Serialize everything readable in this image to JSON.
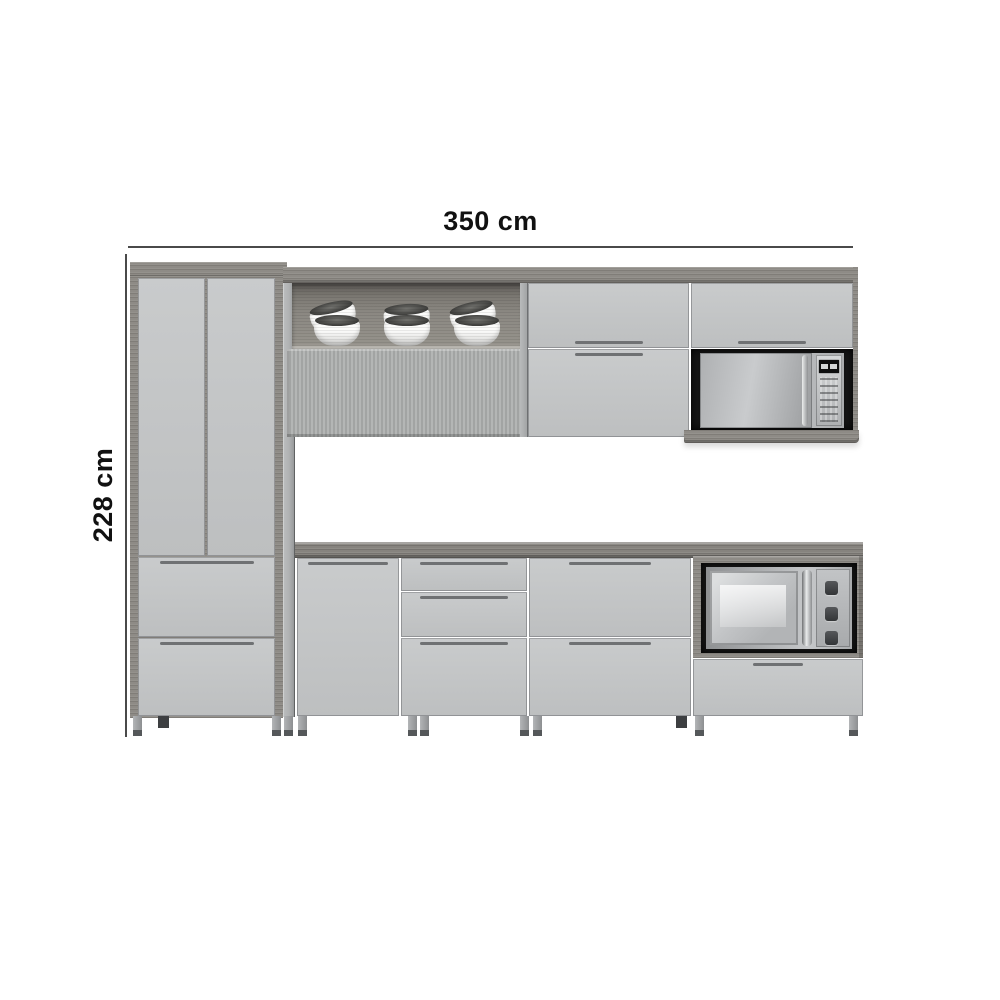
{
  "annotations": {
    "width_label": "350 cm",
    "height_label": "228 cm"
  },
  "scene": {
    "description": "3D render of a gray modular kitchen cabinet set with wood accents",
    "objects": [
      "tall-pantry-cabinet",
      "open-shelf-with-bowls",
      "fluted-lift-door",
      "wall-cabinet-doors",
      "microwave-in-wall-niche",
      "wood-countertop",
      "base-cabinet-door",
      "base-cabinet-drawers",
      "built-in-oven-niche",
      "adjustable-feet"
    ]
  },
  "colors": {
    "bg": "#ffffff",
    "text": "#111111",
    "dim-line": "#4a4a4a",
    "door": "#c4c6c7",
    "door-dark": "#b7b9ba",
    "handle": "#6f7173",
    "wood": "#8e8b86",
    "wood-dark": "#6f6c67",
    "counter": "#86837e",
    "niche-bg": "#8b8882",
    "black-niche": "#171717",
    "appliance": "#b6b8ba",
    "appliance-light": "#d7d9da",
    "flute-a": "#b4b6b5",
    "flute-b": "#a2a4a3",
    "leg": "#9a9c9e",
    "leg-dark": "#55585a",
    "bowl": "#f6f6f5",
    "bowl-rim": "#3a3a38"
  }
}
